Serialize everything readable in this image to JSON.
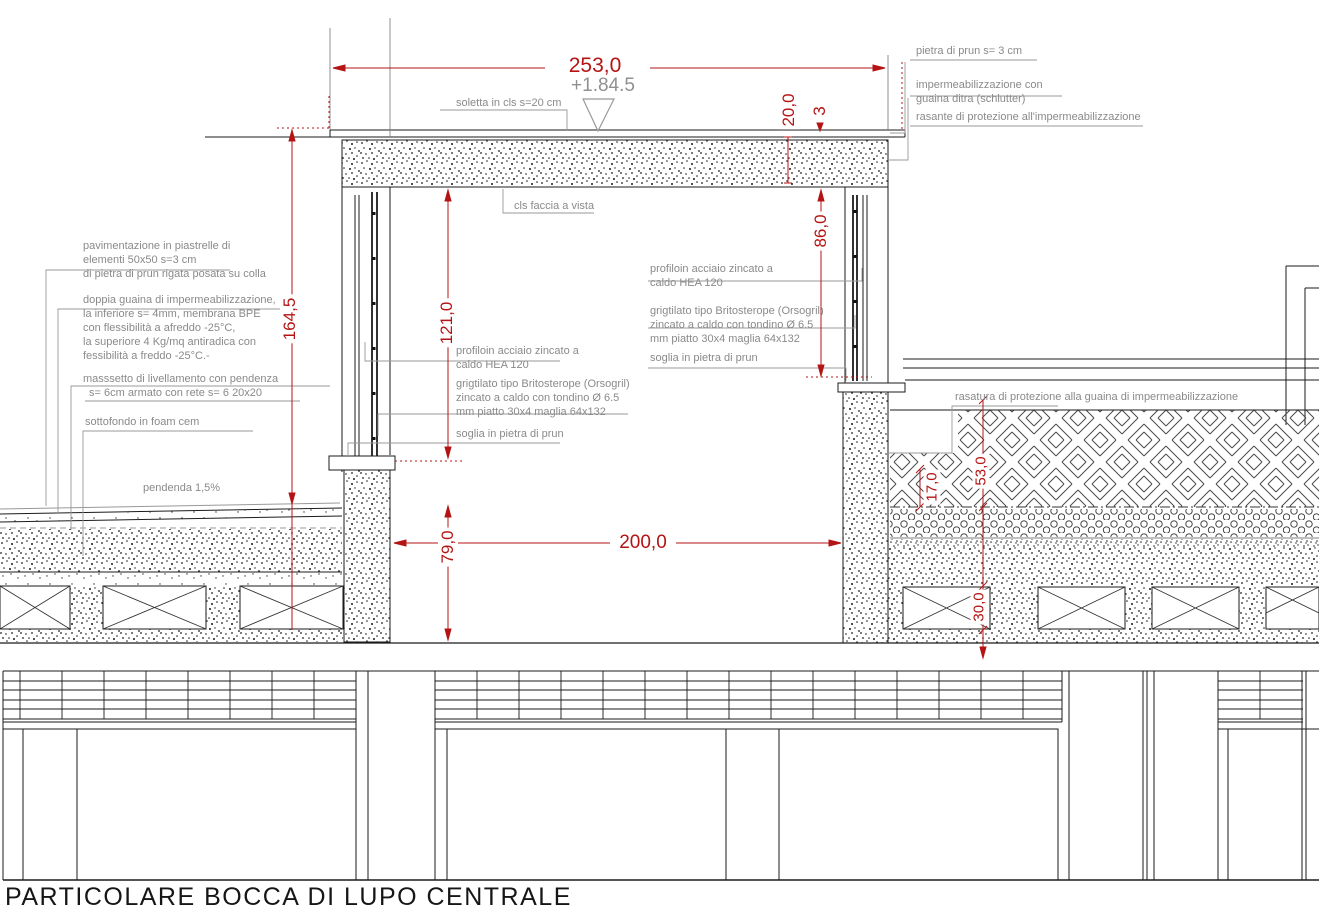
{
  "title": "PARTICOLARE BOCCA DI LUPO CENTRALE",
  "colors": {
    "dimension_red": "#b41414",
    "annotation_grey": "#8a8a8a",
    "linework_black": "#1b1b1b"
  },
  "level_marker": {
    "value": "+1.84.5"
  },
  "dimensions": {
    "top_width": "253,0",
    "slab_thickness": "20,0",
    "stone_cap_thickness": "3",
    "opening_height_right": "86,0",
    "overall_height_left": "164,5",
    "opening_height_left": "121,0",
    "pit_floor_depth": "79,0",
    "clear_width": "200,0",
    "terrace_screed_depth": "17,0",
    "terrace_buildup_depth": "53,0",
    "joist_depth": "30,0"
  },
  "labels": {
    "soletta": "soletta in cls s=20 cm",
    "cls_faccia_vista": "cls faccia a vista",
    "pietra_prun_cap": "pietra di prun s= 3 cm",
    "impermeabilizzazione": [
      "impermeabilizzazione con",
      "guaina ditra (schlutter)"
    ],
    "rasante": "rasante di protezione all'impermeabilizzazione",
    "rasatura": "rasatura di protezione alla guaina di impermeabilizzazione",
    "pavimentazione": [
      "pavimentazione in piastrelle di",
      "elementi 50x50 s=3 cm",
      "di pietra di prun rigata posata su colla"
    ],
    "doppia_guaina": [
      "doppia guaina di impermeabilizzazione,",
      "la inferiore s= 4mm, membrana BPE",
      "con flessibilità a afreddo -25°C,",
      "la superiore 4 Kg/mq antiradica con",
      "fessibilità a freddo -25°C.-"
    ],
    "massetto": [
      "masssetto di livellamento con pendenza",
      "s= 6cm armato con rete s= 6 20x20"
    ],
    "sottofondo": "sottofondo in foam cem",
    "pendenza": "pendenda 1,5%",
    "profilo_acciaio": [
      "profiloin acciaio zincato a",
      "caldo HEA 120"
    ],
    "grigliato": [
      "grigtilato tipo Britosterope (Orsogril)",
      "zincato a caldo con tondino Ø 6.5",
      "mm piatto 30x4 maglia 64x132"
    ],
    "soglia": "soglia in pietra di prun"
  }
}
